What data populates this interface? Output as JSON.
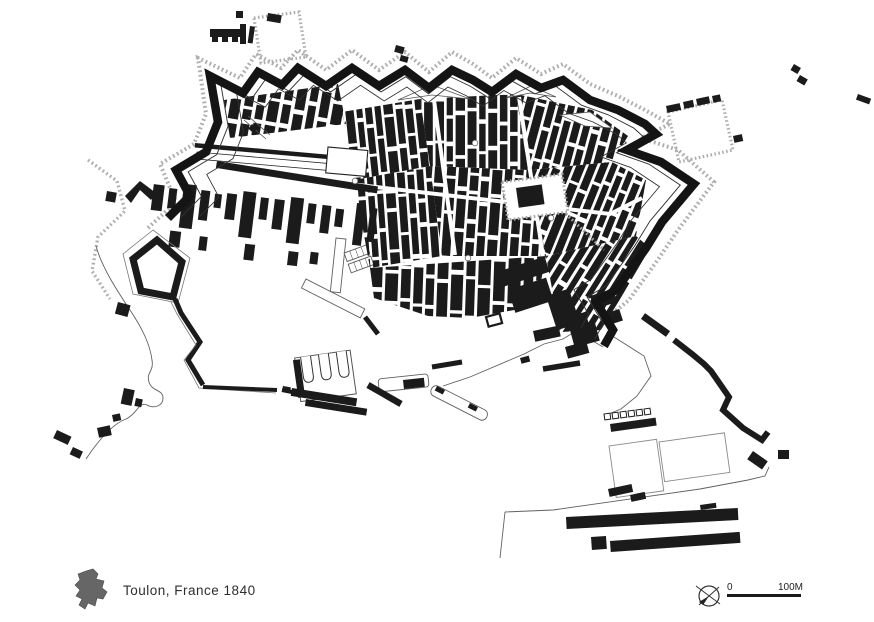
{
  "legend": {
    "title": "Toulon, France 1840"
  },
  "scale": {
    "zero_label": "0",
    "distance_label": "100M"
  },
  "colors": {
    "ink": "#1b1b1b",
    "paper": "#ffffff",
    "stipple": "#a6a6a6",
    "outline": "#555555",
    "legend_blob": "#666666"
  },
  "icons": {
    "compass": "compass-rose-icon",
    "legend_marker": "district-silhouette-icon"
  }
}
